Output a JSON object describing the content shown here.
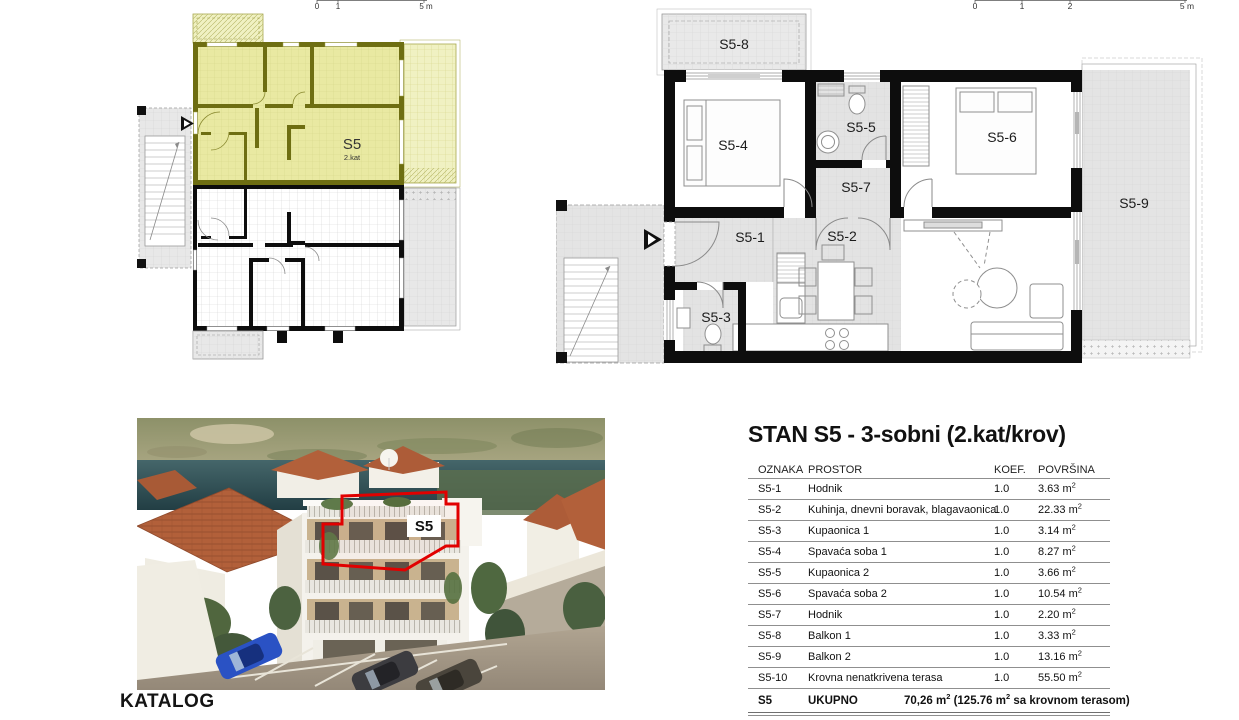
{
  "katalog_label": "KATALOG",
  "colors": {
    "highlight": "#e9e9a2",
    "highlight_wall": "#6e6e12",
    "outline_red": "#e10000"
  },
  "mini_plan": {
    "scale": {
      "t0": "0",
      "t1": "1",
      "t5": "5 m"
    },
    "unit_label": "S5",
    "unit_floor": "2.kat"
  },
  "detail_plan": {
    "scale": {
      "t0": "0",
      "t1": "1",
      "t2": "2",
      "t5": "5 m"
    },
    "rooms": {
      "s5_1": "S5-1",
      "s5_2": "S5-2",
      "s5_3": "S5-3",
      "s5_4": "S5-4",
      "s5_5": "S5-5",
      "s5_6": "S5-6",
      "s5_7": "S5-7",
      "s5_8": "S5-8",
      "s5_9": "S5-9"
    }
  },
  "photo": {
    "unit_label": "S5"
  },
  "spec": {
    "title": "STAN S5 - 3-sobni (2.kat/krov)",
    "columns": [
      "OZNAKA",
      "PROSTOR",
      "KOEF.",
      "POVRŠINA"
    ],
    "rows": [
      {
        "oznaka": "S5-1",
        "prostor": "Hodnik",
        "koef": "1.0",
        "povrsina": "3.63 m²"
      },
      {
        "oznaka": "S5-2",
        "prostor": "Kuhinja, dnevni boravak, blagavaonica",
        "koef": "1.0",
        "povrsina": "22.33 m²"
      },
      {
        "oznaka": "S5-3",
        "prostor": "Kupaonica 1",
        "koef": "1.0",
        "povrsina": "3.14 m²"
      },
      {
        "oznaka": "S5-4",
        "prostor": "Spavaća soba 1",
        "koef": "1.0",
        "povrsina": "8.27 m²"
      },
      {
        "oznaka": "S5-5",
        "prostor": "Kupaonica 2",
        "koef": "1.0",
        "povrsina": "3.66 m²"
      },
      {
        "oznaka": "S5-6",
        "prostor": "Spavaća soba 2",
        "koef": "1.0",
        "povrsina": "10.54 m²"
      },
      {
        "oznaka": "S5-7",
        "prostor": "Hodnik",
        "koef": "1.0",
        "povrsina": "2.20 m²"
      },
      {
        "oznaka": "S5-8",
        "prostor": "Balkon 1",
        "koef": "1.0",
        "povrsina": "3.33 m²"
      },
      {
        "oznaka": "S5-9",
        "prostor": "Balkon 2",
        "koef": "1.0",
        "povrsina": "13.16 m²"
      },
      {
        "oznaka": "S5-10",
        "prostor": "Krovna nenatkrivena terasa",
        "koef": "1.0",
        "povrsina": "55.50 m²"
      }
    ],
    "total": {
      "oznaka": "S5",
      "label": "UKUPNO",
      "value": "70,26 m² (125.76 m² sa krovnom terasom)"
    }
  }
}
